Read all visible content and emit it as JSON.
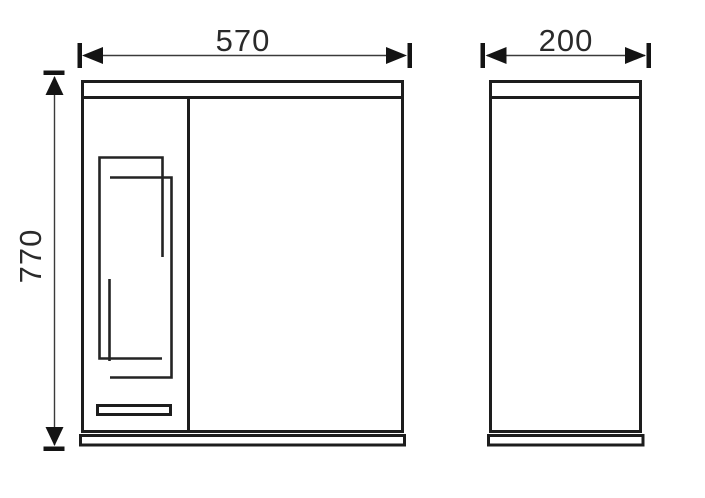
{
  "drawing": {
    "background_color": "#ffffff",
    "object_line_color": "#1d1d1d",
    "dimension_line_color": "#3a3a3a",
    "text_color": "#2a2a2a",
    "front_view": {
      "width_label": "570",
      "height_label": "770"
    },
    "side_view": {
      "depth_label": "200"
    }
  }
}
